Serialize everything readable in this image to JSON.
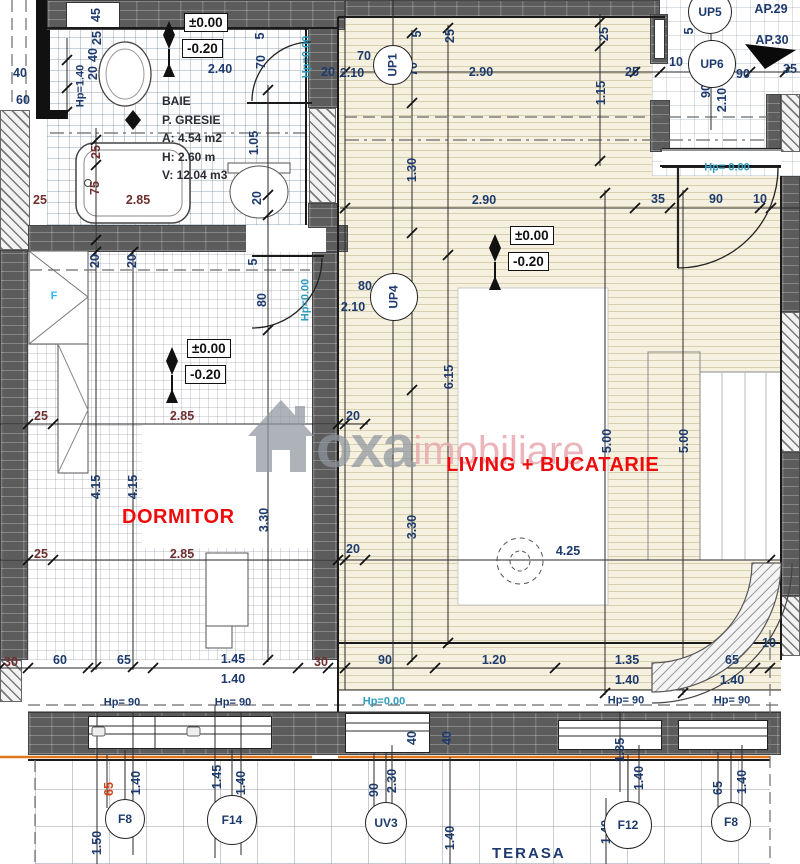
{
  "colors": {
    "wall": "#5c5c5c",
    "accent_red": "#ee0b0b",
    "dim_navy": "#1d3a6d",
    "dim_maroon": "#6e2f2f",
    "hp_cyan": "#2e9bbf",
    "orange_line": "#e0761e",
    "watermark_gray": "#8f979f",
    "watermark_pink": "#e7aab1"
  },
  "rooms": {
    "bathroom": {
      "l1": "BAIE",
      "l2": "P. GRESIE",
      "l3": "A: 4.54 m2",
      "l4": "H: 2.60 m",
      "l5": "V: 12.04 m3"
    },
    "bedroom_label": "DORMITOR",
    "living_label": "LIVING + BUCATARIE",
    "terrace_label": "TERASA"
  },
  "watermark": {
    "brand": "oxa",
    "word": "imobiliare"
  },
  "wardrobe_mark": "F",
  "level_markers": [
    {
      "upper": "±0.00",
      "lower": "-0.20"
    },
    {
      "upper": "±0.00",
      "lower": "-0.20"
    },
    {
      "upper": "±0.00",
      "lower": "-0.20"
    }
  ],
  "apartments": [
    {
      "t": "AP.29",
      "x": 771,
      "y": 9
    },
    {
      "t": "AP.30",
      "x": 772,
      "y": 40
    }
  ],
  "circles": [
    {
      "t": "UP1",
      "x": 393,
      "y": 65,
      "r": 20,
      "v": 1
    },
    {
      "t": "UP4",
      "x": 394,
      "y": 297,
      "r": 24,
      "v": 1
    },
    {
      "t": "UP5",
      "x": 710,
      "y": 12,
      "r": 22
    },
    {
      "t": "UP6",
      "x": 712,
      "y": 64,
      "r": 24
    },
    {
      "t": "F8",
      "x": 125,
      "y": 819,
      "r": 20
    },
    {
      "t": "F14",
      "x": 232,
      "y": 820,
      "r": 25
    },
    {
      "t": "UV3",
      "x": 386,
      "y": 823,
      "r": 21
    },
    {
      "t": "F12",
      "x": 628,
      "y": 825,
      "r": 24
    },
    {
      "t": "F8",
      "x": 731,
      "y": 822,
      "r": 20
    }
  ],
  "hp_labels": [
    {
      "t": "Hp=1.40",
      "x": 81,
      "y": 86,
      "v": 1,
      "c": "navy"
    },
    {
      "t": "Hp=0.00",
      "x": 307,
      "y": 57,
      "v": 1,
      "c": "cyan"
    },
    {
      "t": "Hp=0.00",
      "x": 306,
      "y": 300,
      "v": 1,
      "c": "cyan"
    },
    {
      "t": "Hp= 0.00",
      "x": 727,
      "y": 168,
      "c": "cyan"
    },
    {
      "t": "Hp= 90",
      "x": 122,
      "y": 703,
      "c": "navy"
    },
    {
      "t": "Hp= 90",
      "x": 233,
      "y": 703,
      "c": "navy"
    },
    {
      "t": "Hp=0.00",
      "x": 384,
      "y": 702,
      "c": "cyan"
    },
    {
      "t": "Hp= 90",
      "x": 626,
      "y": 701,
      "c": "navy"
    },
    {
      "t": "Hp= 90",
      "x": 732,
      "y": 701,
      "c": "navy"
    }
  ],
  "dims": [
    {
      "t": "40",
      "x": 20,
      "y": 73
    },
    {
      "t": "60",
      "x": 23,
      "y": 100
    },
    {
      "t": "45",
      "x": 96,
      "y": 15,
      "v": 1
    },
    {
      "t": "25",
      "x": 97,
      "y": 38,
      "v": 1
    },
    {
      "t": "40",
      "x": 93,
      "y": 55,
      "v": 1
    },
    {
      "t": "20",
      "x": 93,
      "y": 73,
      "v": 1
    },
    {
      "t": "2.40",
      "x": 220,
      "y": 69
    },
    {
      "t": "2.85",
      "x": 138,
      "y": 200,
      "c": "maroon"
    },
    {
      "t": "75",
      "x": 95,
      "y": 188,
      "v": 1,
      "c": "maroon"
    },
    {
      "t": "25",
      "x": 96,
      "y": 152,
      "v": 1,
      "c": "maroon"
    },
    {
      "t": "25",
      "x": 40,
      "y": 200,
      "c": "maroon"
    },
    {
      "t": "1.05",
      "x": 254,
      "y": 143,
      "v": 1
    },
    {
      "t": "20",
      "x": 257,
      "y": 198,
      "v": 1
    },
    {
      "t": "5",
      "x": 260,
      "y": 36,
      "v": 1
    },
    {
      "t": "70",
      "x": 261,
      "y": 62,
      "v": 1
    },
    {
      "t": "20",
      "x": 328,
      "y": 72
    },
    {
      "t": "2.10",
      "x": 352,
      "y": 73
    },
    {
      "t": "70",
      "x": 364,
      "y": 56
    },
    {
      "t": "70",
      "x": 413,
      "y": 69,
      "v": 1
    },
    {
      "t": "5",
      "x": 417,
      "y": 34,
      "v": 1
    },
    {
      "t": "25",
      "x": 450,
      "y": 36,
      "v": 1
    },
    {
      "t": "2.90",
      "x": 481,
      "y": 72
    },
    {
      "t": "25",
      "x": 604,
      "y": 34,
      "v": 1
    },
    {
      "t": "25",
      "x": 632,
      "y": 72
    },
    {
      "t": "1.15",
      "x": 601,
      "y": 93,
      "v": 1
    },
    {
      "t": "1.30",
      "x": 412,
      "y": 170,
      "v": 1
    },
    {
      "t": "2.90",
      "x": 484,
      "y": 200
    },
    {
      "t": "35",
      "x": 658,
      "y": 199
    },
    {
      "t": "90",
      "x": 716,
      "y": 199
    },
    {
      "t": "10",
      "x": 760,
      "y": 199
    },
    {
      "t": "10",
      "x": 676,
      "y": 62
    },
    {
      "t": "90",
      "x": 743,
      "y": 74
    },
    {
      "t": "35",
      "x": 790,
      "y": 69
    },
    {
      "t": "5",
      "x": 689,
      "y": 31,
      "v": 1
    },
    {
      "t": "90",
      "x": 706,
      "y": 91,
      "v": 1
    },
    {
      "t": "2.10",
      "x": 722,
      "y": 100,
      "v": 1
    },
    {
      "t": "25",
      "x": 41,
      "y": 416,
      "c": "maroon"
    },
    {
      "t": "2.85",
      "x": 182,
      "y": 416,
      "c": "maroon"
    },
    {
      "t": "20",
      "x": 353,
      "y": 416
    },
    {
      "t": "20",
      "x": 95,
      "y": 261,
      "v": 1
    },
    {
      "t": "20",
      "x": 132,
      "y": 261,
      "v": 1
    },
    {
      "t": "5",
      "x": 253,
      "y": 262,
      "v": 1
    },
    {
      "t": "80",
      "x": 262,
      "y": 300,
      "v": 1
    },
    {
      "t": "2.85",
      "x": 182,
      "y": 554,
      "c": "maroon"
    },
    {
      "t": "25",
      "x": 41,
      "y": 554,
      "c": "maroon"
    },
    {
      "t": "4.15",
      "x": 96,
      "y": 487,
      "v": 1
    },
    {
      "t": "4.15",
      "x": 133,
      "y": 487,
      "v": 1
    },
    {
      "t": "3.30",
      "x": 264,
      "y": 520,
      "v": 1
    },
    {
      "t": "6.15",
      "x": 449,
      "y": 377,
      "v": 1
    },
    {
      "t": "3.30",
      "x": 412,
      "y": 527,
      "v": 1
    },
    {
      "t": "20",
      "x": 353,
      "y": 549
    },
    {
      "t": "4.25",
      "x": 568,
      "y": 551
    },
    {
      "t": "5.00",
      "x": 607,
      "y": 441,
      "v": 1
    },
    {
      "t": "5.00",
      "x": 684,
      "y": 441,
      "v": 1
    },
    {
      "t": "80",
      "x": 365,
      "y": 286
    },
    {
      "t": "2.10",
      "x": 353,
      "y": 307
    },
    {
      "t": "80",
      "x": 413,
      "y": 300,
      "v": 1
    },
    {
      "t": "1.20",
      "x": 494,
      "y": 660
    },
    {
      "t": "90",
      "x": 385,
      "y": 660
    },
    {
      "t": "1.35",
      "x": 627,
      "y": 660
    },
    {
      "t": "1.40",
      "x": 627,
      "y": 680
    },
    {
      "t": "65",
      "x": 732,
      "y": 660
    },
    {
      "t": "1.40",
      "x": 732,
      "y": 680
    },
    {
      "t": "10",
      "x": 769,
      "y": 643
    },
    {
      "t": "30",
      "x": 11,
      "y": 662,
      "c": "maroon"
    },
    {
      "t": "60",
      "x": 60,
      "y": 660
    },
    {
      "t": "65",
      "x": 124,
      "y": 660
    },
    {
      "t": "1.45",
      "x": 233,
      "y": 659
    },
    {
      "t": "1.40",
      "x": 233,
      "y": 679
    },
    {
      "t": "30",
      "x": 321,
      "y": 662,
      "c": "maroon"
    },
    {
      "t": "40",
      "x": 412,
      "y": 738,
      "v": 1
    },
    {
      "t": "40",
      "x": 447,
      "y": 738,
      "v": 1
    },
    {
      "t": "65",
      "x": 109,
      "y": 789,
      "v": 1,
      "c": "red"
    },
    {
      "t": "1.40",
      "x": 136,
      "y": 783,
      "v": 1
    },
    {
      "t": "1.45",
      "x": 217,
      "y": 777,
      "v": 1
    },
    {
      "t": "1.40",
      "x": 241,
      "y": 783,
      "v": 1
    },
    {
      "t": "1.50",
      "x": 97,
      "y": 843,
      "v": 1
    },
    {
      "t": "90",
      "x": 374,
      "y": 790,
      "v": 1
    },
    {
      "t": "2.30",
      "x": 392,
      "y": 781,
      "v": 1
    },
    {
      "t": "1.40",
      "x": 450,
      "y": 838,
      "v": 1
    },
    {
      "t": "1.35",
      "x": 620,
      "y": 750,
      "v": 1
    },
    {
      "t": "1.40",
      "x": 639,
      "y": 778,
      "v": 1
    },
    {
      "t": "1.40",
      "x": 606,
      "y": 832,
      "v": 1
    },
    {
      "t": "65",
      "x": 718,
      "y": 788,
      "v": 1
    },
    {
      "t": "1.40",
      "x": 742,
      "y": 782,
      "v": 1
    }
  ]
}
